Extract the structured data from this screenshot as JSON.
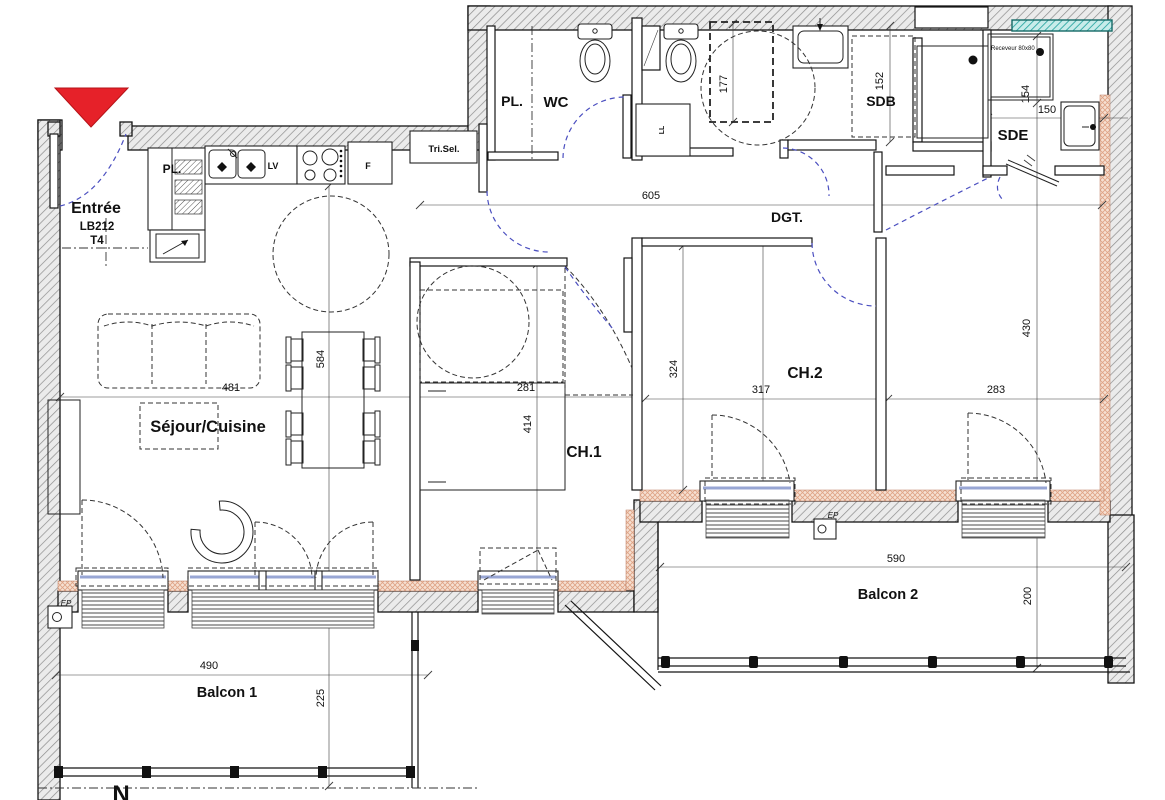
{
  "plan": {
    "unit": {
      "entrance": "Entrée",
      "code": "LB212",
      "type": "T4"
    },
    "rooms": {
      "pl_entree": "PL.",
      "pl_wc": "PL.",
      "wc": "WC",
      "sdb": "SDB",
      "sde": "SDE",
      "dgt": "DGT.",
      "sejour": "Séjour/Cuisine",
      "ch1": "CH.1",
      "ch2": "CH.2",
      "balcon1": "Balcon 1",
      "balcon2": "Balcon 2"
    },
    "equipment": {
      "tri_sel": "Tri.Sel.",
      "receveur": "Receveur 80x80",
      "dishwasher": "LV",
      "fridge": "F",
      "washer": "LL",
      "ep_1": "EP",
      "ep_2": "EP",
      "north": "N"
    },
    "dims": {
      "d605": "605",
      "d177": "177",
      "d152": "152",
      "d154": "154",
      "d150": "150",
      "d481": "481",
      "d584": "584",
      "d281": "281",
      "d414": "414",
      "d324": "324",
      "d317": "317",
      "d283": "283",
      "d430": "430",
      "d490": "490",
      "d225": "225",
      "d590": "590",
      "d200": "200"
    },
    "colors": {
      "arrow_red": "#e62129",
      "door_arc_blue": "#4b4fc0",
      "glazing_blue": "#98a6d4",
      "insulation_pink": "#f6e0d2",
      "teal_strip": "#2fa8a4",
      "wall_gray": "#ebebeb"
    }
  }
}
